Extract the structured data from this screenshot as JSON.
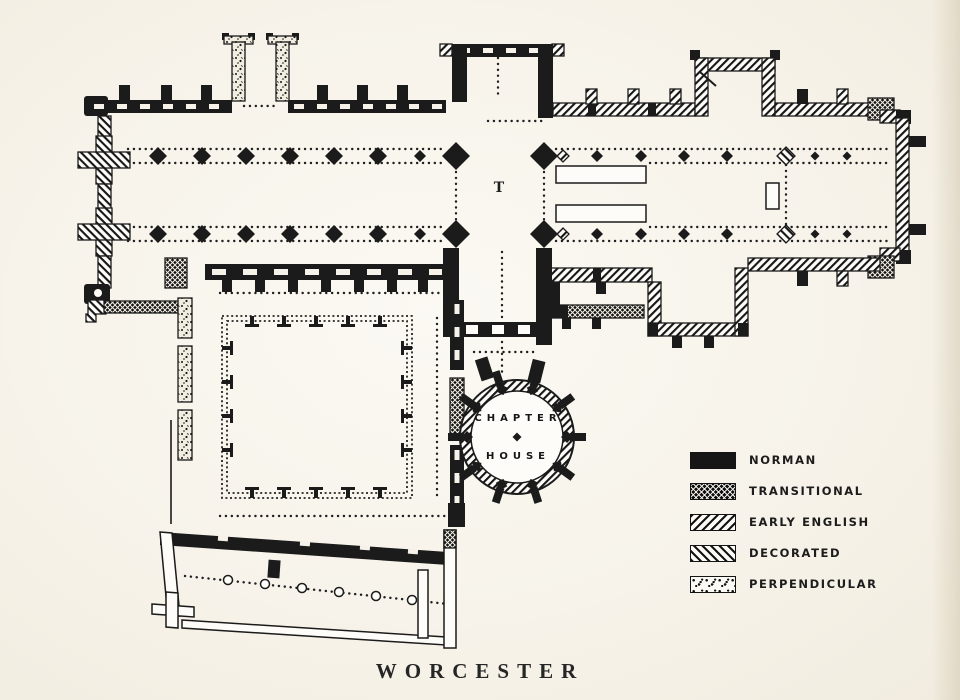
{
  "page": {
    "background": "#f7f3ea",
    "ink": "#1b1b1b"
  },
  "title": {
    "text": "WORCESTER"
  },
  "plan": {
    "tower_label": "T",
    "chapter_house": {
      "line1": "CHAPTER",
      "line2": "HOUSE"
    }
  },
  "legend": {
    "items": [
      {
        "label": "NORMAN",
        "pattern": "solid-black"
      },
      {
        "label": "TRANSITIONAL",
        "pattern": "crosshatch"
      },
      {
        "label": "EARLY ENGLISH",
        "pattern": "diagonal-hatch-right"
      },
      {
        "label": "DECORATED",
        "pattern": "diagonal-hatch-left"
      },
      {
        "label": "PERPENDICULAR",
        "pattern": "speckled"
      }
    ]
  }
}
